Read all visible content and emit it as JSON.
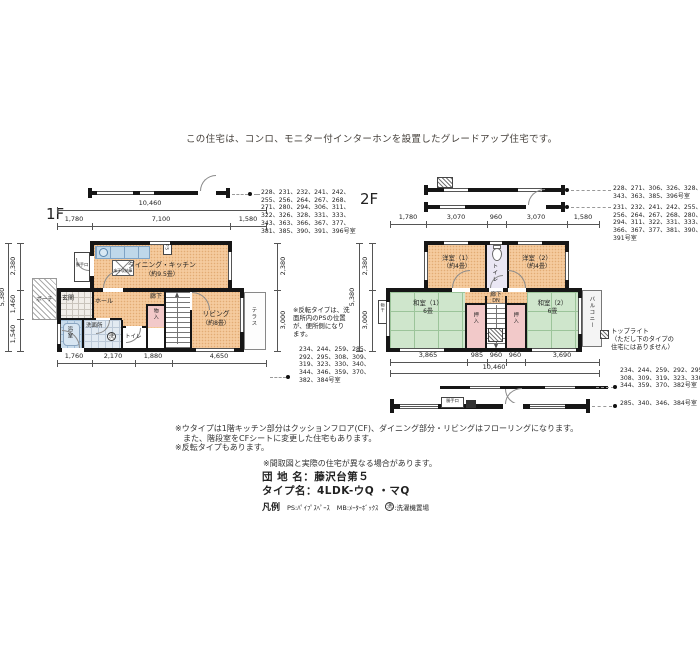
{
  "palette": {
    "wall": "#161616",
    "room_peach": "#F5CB9E",
    "tatami_green": "#CFE6CC",
    "fixture_blue": "#C9DCEC",
    "closet_pink": "#F2C9C9",
    "note_text": "#45403B"
  },
  "page": {
    "top_note": "この住宅は、コンロ、モニター付インターホンを設置したグレードアップ住宅です。",
    "notes_block": "※ウタイプは1階キッチン部分はクッションフロア(CF)、ダイニング部分・リビングはフローリングになります。\n　また、階段室をCFシートに変更した住宅もあります。\n※反転タイプもあります。",
    "note_madorizu": "※間取図と実際の住宅が異なる場合があります。",
    "info": {
      "danchi": "団 地 名：藤沢台第５",
      "type": "タイプ名：4LDK-ウQ ・マQ",
      "legend_label": "凡例",
      "legend_ps": "PS:ﾊﾟｲﾌﾟｽﾍﾟｰｽ",
      "legend_mb": "MB:ﾒｰﾀｰﾎﾞｯｸｽ",
      "legend_sen": "洗",
      "legend_sen_text": ":洗濯機置場"
    }
  },
  "f1": {
    "label": "1F",
    "dims": {
      "total": "10,460",
      "top": [
        "1,780",
        "7,100",
        "1,580"
      ],
      "bottom": [
        "1,760",
        "2,170",
        "1,880",
        "4,650"
      ],
      "left": [
        "2,380",
        "1,460",
        "1,540"
      ],
      "left_total": "5,380",
      "right": [
        "2,380",
        "3,000"
      ]
    },
    "rooms": {
      "dk": "ダイニング・キッチン",
      "dk_size": "（約9.5畳）",
      "living": "リビング",
      "living_size": "（約8畳）",
      "genkan": "玄関",
      "hall": "ホール",
      "rouka": "廊下",
      "porch": "ポーチ",
      "bath": "浴室",
      "wash": "洗面所",
      "laundry": "洗",
      "toilet": "トイレ",
      "mono": "物入",
      "katte": "勝手口",
      "terrace": "テラス",
      "yukashita": "床下収納庫",
      "ps": "PS"
    },
    "lists": {
      "top": "228、231、232、241、242、\n255、256、264、267、268、\n271、280、294、306、311、\n322、326、328、331、333、\n343、363、366、367、377、\n381、385、390、391、396号室",
      "bottom": "234、244、259、285、\n292、295、308、309、\n319、323、330、340、\n344、346、359、370、\n382、384号室"
    },
    "note_hanten": "※反転タイプは、洗\n面所内のPSの位置\nが、便所側になり\nます。"
  },
  "f2": {
    "label": "2F",
    "dims": {
      "top": [
        "1,780",
        "3,070",
        "960",
        "3,070",
        "1,580"
      ],
      "bottom": [
        "3,865",
        "985",
        "960",
        "960",
        "3,690"
      ],
      "bottom_total": "10,460",
      "left": [
        "2,380",
        "3,000"
      ],
      "left_total": "5,380"
    },
    "rooms": {
      "yo1": "洋室（1）",
      "yo1_size": "（約4畳）",
      "yo2": "洋室（2）",
      "yo2_size": "（約4畳）",
      "toilet": "トイレ",
      "rouka": "廊下",
      "dn": "DN",
      "wa1": "和室（1）",
      "wa1_size": "6畳",
      "wa2": "和室（2）",
      "wa2_size": "6畳",
      "oshiire": "押入",
      "balcony": "バルコニー",
      "monohoshi": "物干",
      "strip_label": "勝手口"
    },
    "lists": {
      "top_a": "228、271、306、326、328、\n343、363、385、396号室",
      "top_b": "231、232、241、242、255、\n256、264、267、268、280、\n294、311、322、331、333、\n366、367、377、381、390、\n391号室",
      "bottom_a": "234、244、259、292、295、\n308、309、319、323、330、\n344、359、370、382号室",
      "bottom_b": "285、340、346、384号室"
    },
    "legend_toplight": "トップライト\n（ただし下のタイプの\n住宅にはありません）"
  }
}
